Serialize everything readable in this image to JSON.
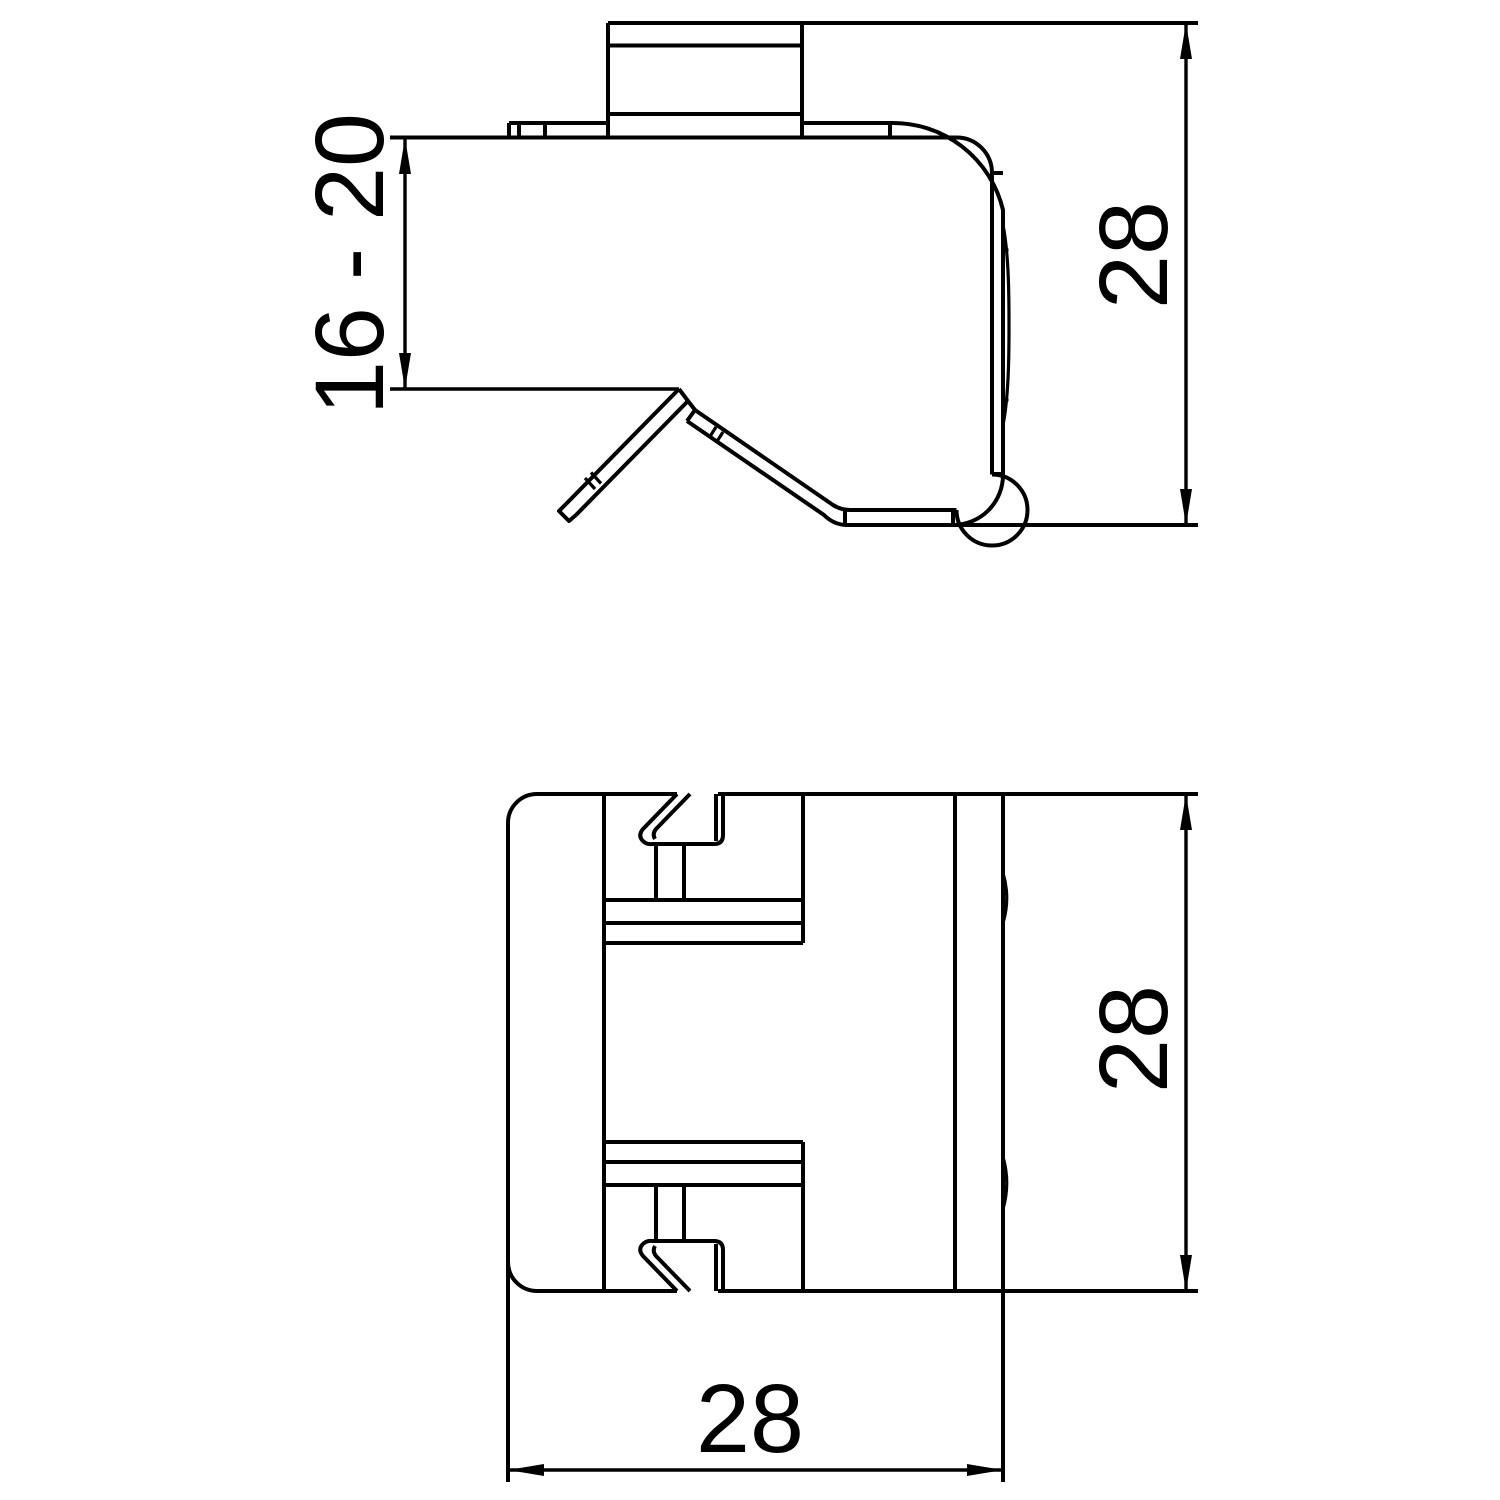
{
  "drawing": {
    "background": "#ffffff",
    "line_color": "#000000",
    "views": {
      "side": {
        "name": "side-view",
        "dim_clamping_range": "16 - 20",
        "dim_height": "28"
      },
      "front": {
        "name": "front-view",
        "dim_height": "28",
        "dim_width": "28"
      }
    }
  }
}
